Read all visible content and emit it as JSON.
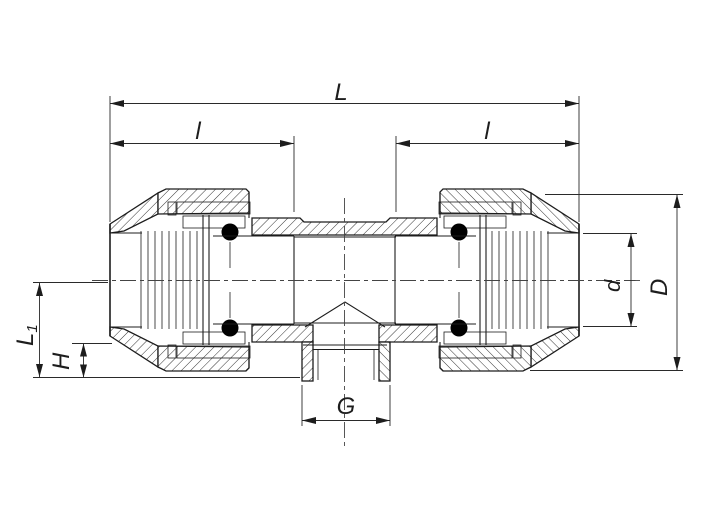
{
  "drawing": {
    "kind": "technical section drawing of a compression tee pipe fitting",
    "colors": {
      "background": "#ffffff",
      "line": "#1d1d1d",
      "seal": "#000000"
    },
    "dimensions": {
      "overall_length": "L",
      "insertion_left": "l",
      "insertion_right": "l",
      "branch_length_base": "L",
      "branch_length_subscript": "1",
      "branch_offset_height": "H",
      "branch_thread": "G",
      "pipe_diameter": "d",
      "outer_diameter": "D"
    }
  }
}
